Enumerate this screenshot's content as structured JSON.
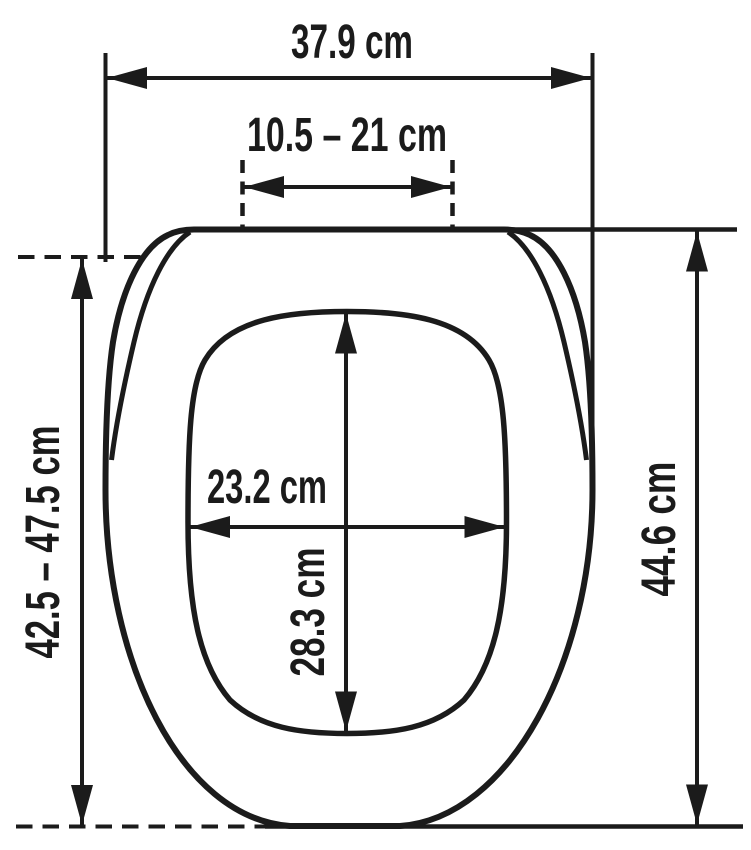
{
  "diagram": {
    "subject": "toilet-seat-dimension-drawing",
    "unit": "cm",
    "colors": {
      "ink": "#1b1b1b",
      "background": "#ffffff"
    },
    "measurements": {
      "outer_width": {
        "label": "37.9 cm",
        "value_cm": 37.9
      },
      "hinge_spacing": {
        "label": "10.5 – 21 cm",
        "min_cm": 10.5,
        "max_cm": 21
      },
      "inner_width": {
        "label": "23.2 cm",
        "value_cm": 23.2
      },
      "inner_depth": {
        "label": "28.3 cm",
        "value_cm": 28.3
      },
      "adjustable_depth": {
        "label": "42.5 – 47.5 cm",
        "min_cm": 42.5,
        "max_cm": 47.5
      },
      "outer_depth": {
        "label": "44.6 cm",
        "value_cm": 44.6
      }
    }
  }
}
